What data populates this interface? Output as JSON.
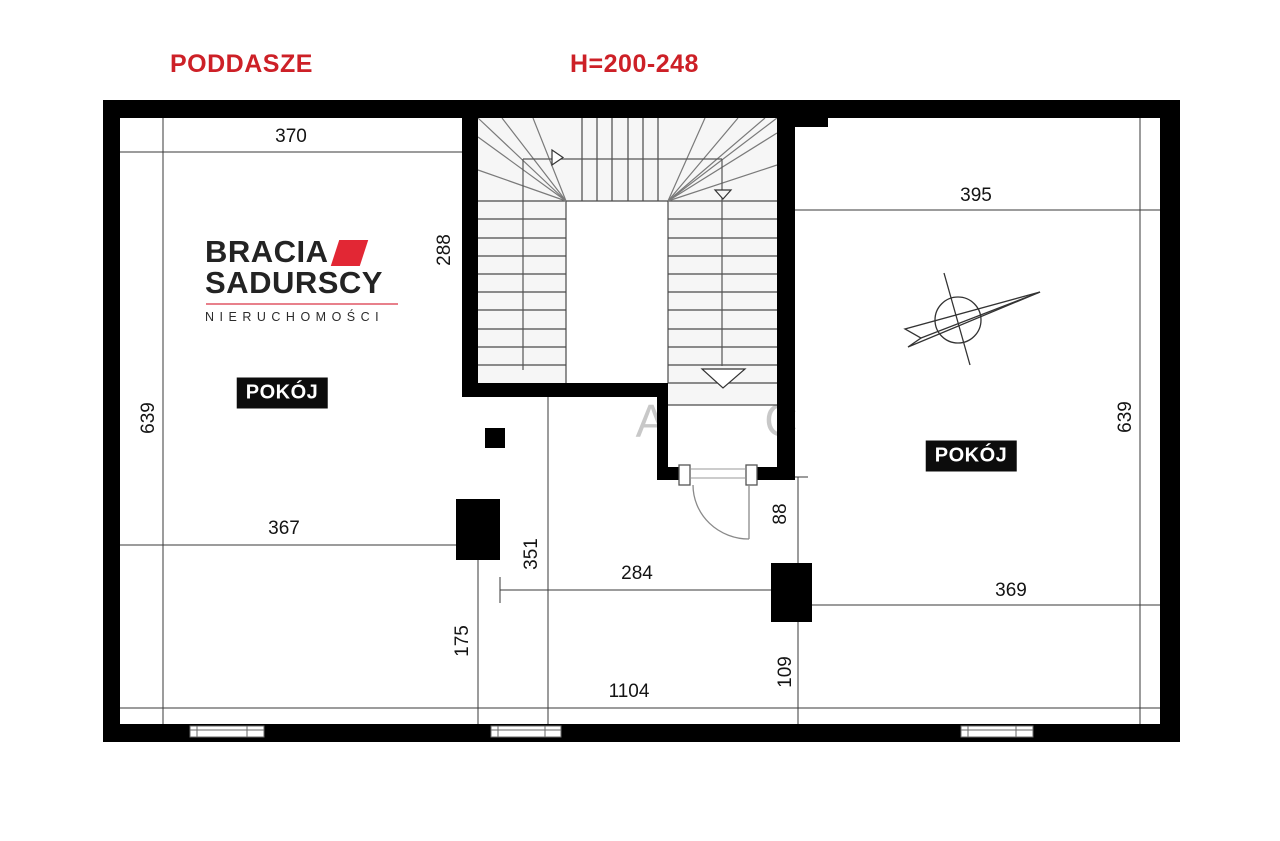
{
  "meta": {
    "accent_red": "#cd2027",
    "logo_red": "#e22734",
    "wall_black": "#000000",
    "watermark_gray": "#c8c8c8"
  },
  "titles": {
    "floor": "PODDASZE",
    "height_range": "H=200-248"
  },
  "logo": {
    "brand_top": "BRACIA",
    "brand_bottom": "SADURSCY",
    "subtitle": "NIERUCHOMOŚCI"
  },
  "watermark": {
    "a": "A",
    "c": "C"
  },
  "rooms": {
    "left": "POKÓJ",
    "right": "POKÓJ"
  },
  "dims": {
    "w370": "370",
    "w288": "288",
    "h639_left": "639",
    "w367": "367",
    "h351": "351",
    "h175": "175",
    "w284": "284",
    "h88": "88",
    "w1104": "1104",
    "h109": "109",
    "w395": "395",
    "w369": "369",
    "h639_right": "639"
  }
}
